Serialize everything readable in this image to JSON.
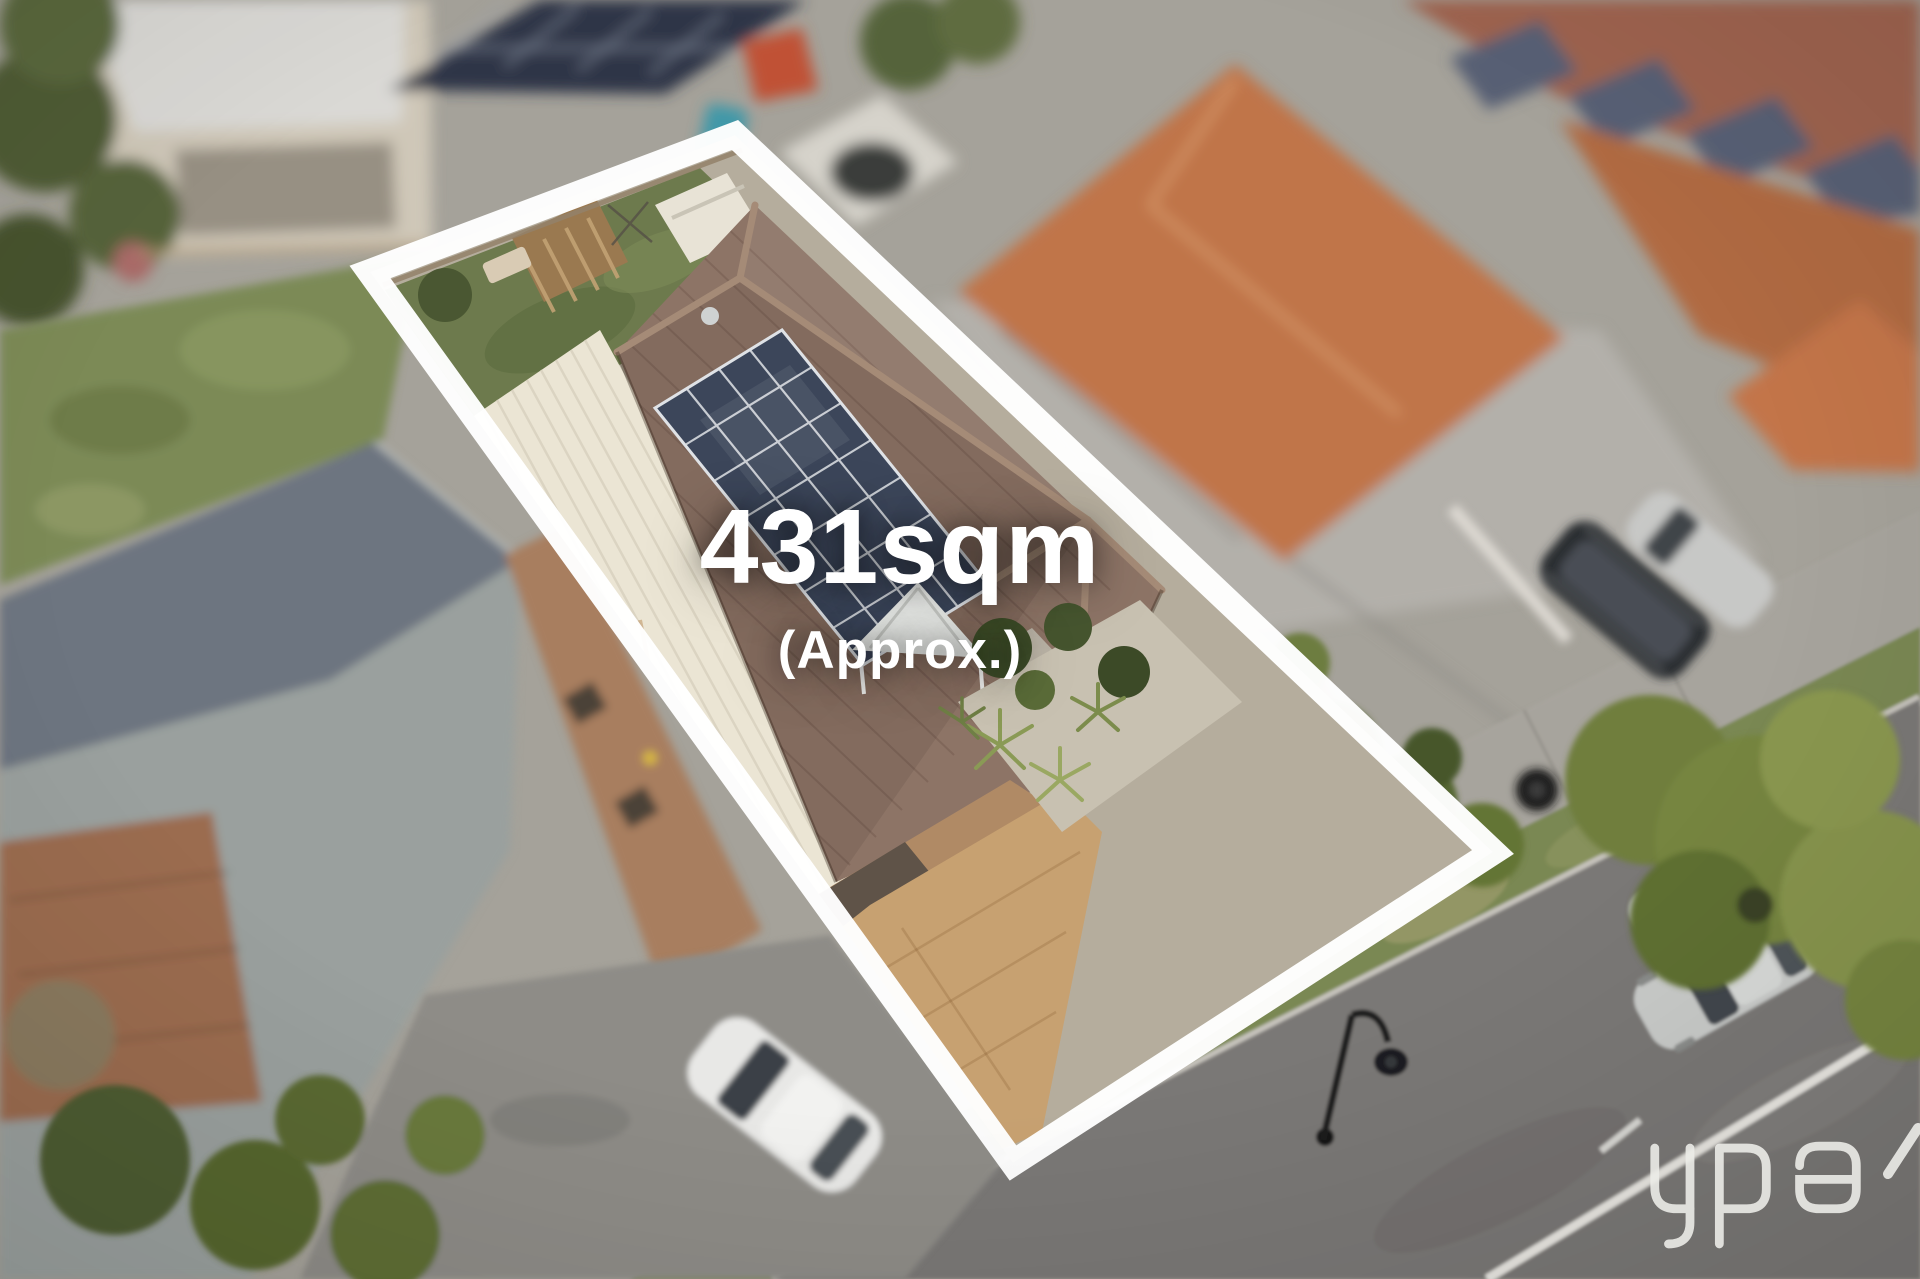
{
  "overlay": {
    "area_label": "431sqm",
    "approx_label": "(Approx.)",
    "text_color": "#ffffff"
  },
  "watermark": {
    "text": "ypa",
    "color": "#edece8"
  },
  "scene": {
    "description": "Aerial drone photo of a suburban property outlined in white",
    "boundary_color": "#ffffff",
    "subject_roof_color": "#8d7466",
    "roof_ridge_color": "#a58b77",
    "solar_panel_color": "#3c465a",
    "solar_grid_color": "#cfd3d8",
    "garage_roof_color": "#ebe5d4",
    "lawn_color": "#6d7a4d",
    "shed_roof_color": "#e8e3d6",
    "pergola_color": "#9a7950",
    "driveway_color": "#c7a171",
    "porch_canopy_color": "#e9ebe8",
    "front_wall_color": "#b08a65",
    "garden_pebble_color": "#c8c1b1",
    "left_roof_light_color": "#9aa09e",
    "left_roof_dark_color": "#6d7580",
    "left_grass_color": "#7c8a57",
    "brick_wall_color": "#a87e5f",
    "right_roof_color": "#c0744a",
    "far_roof_color": "#9e6350",
    "wall_gray_color": "#b3b0aa",
    "road_color": "#7a7876",
    "footpath_color": "#a7a49d",
    "nature_strip_color": "#7a8853",
    "curb_color": "#c6c3bc",
    "road_line_color": "#e9e7e2",
    "tree_color": "#76853f",
    "white_car_color": "#e8e8e6",
    "silver_car_color": "#c9cbc9",
    "suv_color": "#2b2d30"
  }
}
